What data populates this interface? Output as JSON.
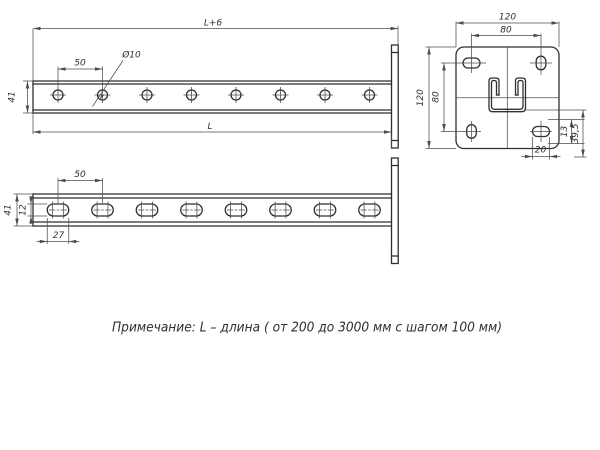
{
  "colors": {
    "line": "#2f2f2f",
    "thin_line": "#4d4d4d",
    "background": "#ffffff"
  },
  "views": {
    "face": {
      "overall_length": "L+6",
      "hole_pitch": "50",
      "hole_diameter": "Ø10",
      "profile_height": "41",
      "length": "L"
    },
    "slotted": {
      "slot_pitch": "50",
      "profile_height": "41",
      "slot_width": "12",
      "slot_length": "27"
    },
    "plate": {
      "width": "120",
      "hole_pitch_horizontal": "80",
      "height": "120",
      "hole_pitch_vertical": "80",
      "dim_13": "13",
      "dim_39_5": "39,5",
      "slot_length": "20"
    }
  },
  "note": "Примечание: L – длина ( от 200 до 3000 мм с шагом 100 мм)"
}
